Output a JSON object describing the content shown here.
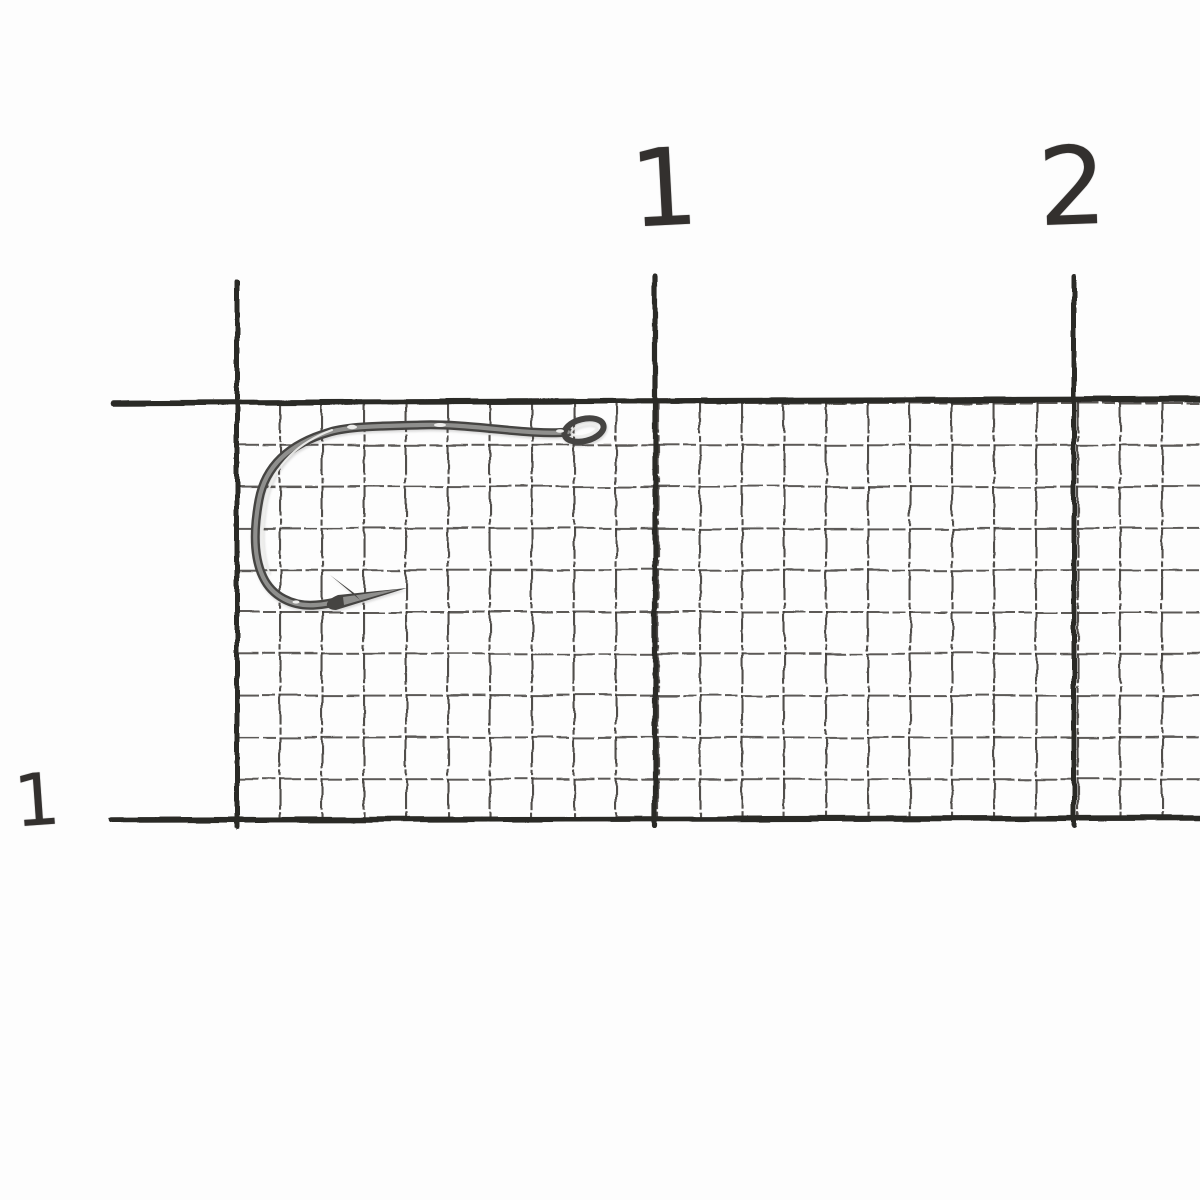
{
  "scene": {
    "description": "Single metallic fishing hook lying on white millimeter graph paper, photographed for scale",
    "background_color": "#fdfdfd",
    "grid_color": "#3f3c39",
    "major_line_color": "#2c2a28",
    "hook_colors": {
      "outline": "#454442",
      "body": "#8f8f8d",
      "highlight": "#ededeb"
    }
  },
  "ruler": {
    "top_labels": [
      {
        "text": "1"
      },
      {
        "text": "2"
      }
    ],
    "left_labels": [
      {
        "text": "1"
      }
    ]
  }
}
